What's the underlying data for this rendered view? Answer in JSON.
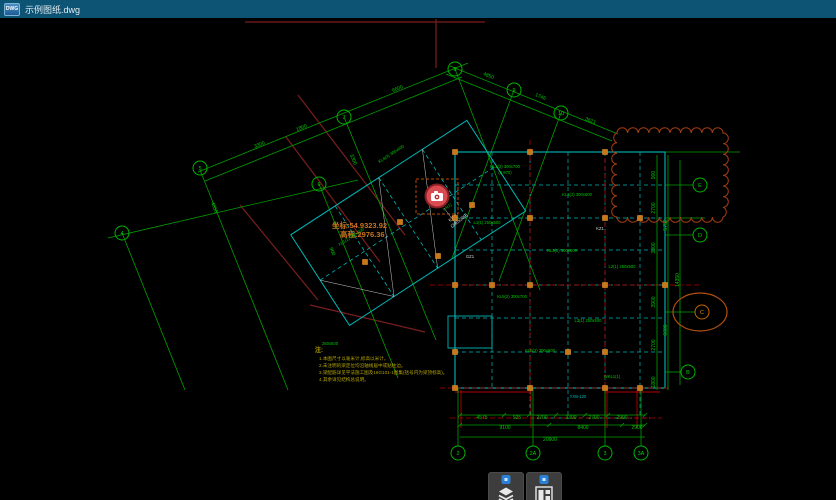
{
  "window": {
    "badge": "DWG",
    "title": "示例图纸.dwg"
  },
  "toolbar": {
    "buttons": [
      {
        "name": "layers-button",
        "icon": "layers-icon"
      },
      {
        "name": "layouts-button",
        "icon": "layouts-icon"
      }
    ]
  },
  "colors": {
    "titlebar": "#0d5373",
    "canvas": "#000000",
    "dim_green": "#00c800",
    "axis_green": "#00a000",
    "beam_cyan": "#00b8b8",
    "column_orange": "#c87818",
    "red": "#b40000",
    "dark_red": "#7a1e1e",
    "cloud_orange": "#a03c14",
    "note_yellow": "#b4a400",
    "coord_orange": "#c87420",
    "marker_red": "#d84c52",
    "badge_blue": "#2b7fd4"
  },
  "drawing": {
    "coordinates": {
      "line1": "坐标:54.9323.92",
      "line2": "高程:2976.36"
    },
    "camera_marker": {
      "label_line1": "KZ-1",
      "label_line2": "(300x300)"
    },
    "notes": {
      "title": "注:",
      "items": [
        "1.本图尺寸以毫米计,标高以米计。",
        "2.未注明的梁定位均沿轴线居中或贴柱边。",
        "3.梁配筋详见平法施工图及16G101-1图集(括号内为梁顶标高)。",
        "4.其余详见结构总说明。"
      ]
    },
    "grid_bubbles": [
      {
        "x": 455,
        "y": 69,
        "label": "8"
      },
      {
        "x": 514,
        "y": 90,
        "label": "9"
      },
      {
        "x": 561,
        "y": 113,
        "label": "10"
      },
      {
        "x": 344,
        "y": 117,
        "label": "7"
      },
      {
        "x": 319,
        "y": 184,
        "label": "6"
      },
      {
        "x": 200,
        "y": 168,
        "label": "5"
      },
      {
        "x": 122,
        "y": 233,
        "label": "4"
      },
      {
        "x": 458,
        "y": 453,
        "label": "2"
      },
      {
        "x": 533,
        "y": 453,
        "label": "2A"
      },
      {
        "x": 605,
        "y": 453,
        "label": "3"
      },
      {
        "x": 641,
        "y": 453,
        "label": "3A"
      },
      {
        "x": 700,
        "y": 185,
        "label": "E"
      },
      {
        "x": 700,
        "y": 235,
        "label": "D"
      },
      {
        "x": 702,
        "y": 312,
        "label": "C",
        "highlight": true
      },
      {
        "x": 688,
        "y": 372,
        "label": "B"
      }
    ],
    "dimensions": [
      {
        "x": 482,
        "y": 419,
        "t": "4575"
      },
      {
        "x": 517,
        "y": 419,
        "t": "925"
      },
      {
        "x": 542,
        "y": 419,
        "t": "2700"
      },
      {
        "x": 571,
        "y": 419,
        "t": "3300"
      },
      {
        "x": 594,
        "y": 419,
        "t": "2700"
      },
      {
        "x": 622,
        "y": 419,
        "t": "2900"
      },
      {
        "x": 505,
        "y": 429,
        "t": "9100"
      },
      {
        "x": 583,
        "y": 429,
        "t": "8400"
      },
      {
        "x": 637,
        "y": 429,
        "t": "2900"
      },
      {
        "x": 550,
        "y": 441,
        "t": "20900"
      },
      {
        "x": 655,
        "y": 175,
        "t": "900",
        "r": -90
      },
      {
        "x": 655,
        "y": 208,
        "t": "2700",
        "r": -90
      },
      {
        "x": 655,
        "y": 248,
        "t": "3300",
        "r": -90
      },
      {
        "x": 655,
        "y": 302,
        "t": "3900",
        "r": -90
      },
      {
        "x": 655,
        "y": 345,
        "t": "2700",
        "r": -90
      },
      {
        "x": 655,
        "y": 382,
        "t": "1800",
        "r": -90
      },
      {
        "x": 667,
        "y": 225,
        "t": "5750",
        "r": -90
      },
      {
        "x": 667,
        "y": 330,
        "t": "6600",
        "r": -90
      },
      {
        "x": 679,
        "y": 280,
        "t": "14350",
        "r": -90
      },
      {
        "x": 488,
        "y": 77,
        "t": "4850",
        "r": 22
      },
      {
        "x": 540,
        "y": 98,
        "t": "1746",
        "r": 22
      },
      {
        "x": 590,
        "y": 122,
        "t": "3621",
        "r": 22
      },
      {
        "x": 260,
        "y": 146,
        "t": "3300",
        "r": -22
      },
      {
        "x": 302,
        "y": 129,
        "t": "1800",
        "r": -22
      },
      {
        "x": 398,
        "y": 90,
        "t": "6600",
        "r": -22
      },
      {
        "x": 213,
        "y": 208,
        "t": "4850",
        "r": 68
      },
      {
        "x": 352,
        "y": 160,
        "t": "3300",
        "r": 68
      },
      {
        "x": 331,
        "y": 252,
        "t": "900",
        "r": 68
      }
    ],
    "beam_labels": [
      {
        "x": 505,
        "y": 168,
        "t": "KL1(2) 300x700"
      },
      {
        "x": 505,
        "y": 174,
        "t": "(5.970)"
      },
      {
        "x": 577,
        "y": 196,
        "t": "KL2(2) 300x600"
      },
      {
        "x": 487,
        "y": 224,
        "t": "L1(1) 250x500"
      },
      {
        "x": 562,
        "y": 252,
        "t": "KL3(2) 300x600"
      },
      {
        "x": 622,
        "y": 268,
        "t": "L2(1) 250x500"
      },
      {
        "x": 512,
        "y": 298,
        "t": "KL5(2) 300x700"
      },
      {
        "x": 588,
        "y": 322,
        "t": "L3(1) 250x500"
      },
      {
        "x": 540,
        "y": 352,
        "t": "KL6(2) 300x600"
      },
      {
        "x": 612,
        "y": 378,
        "t": "WKL1(1)"
      },
      {
        "x": 578,
        "y": 398,
        "t": "YXB-120",
        "c": "#00b8b8"
      },
      {
        "x": 352,
        "y": 238,
        "t": "XL1(1) 250x500",
        "r": -33
      },
      {
        "x": 392,
        "y": 155,
        "t": "KL8(3) 300x600",
        "r": -33
      },
      {
        "x": 448,
        "y": 208,
        "t": "L4(1)",
        "r": -33
      },
      {
        "x": 470,
        "y": 258,
        "t": "GZ1",
        "c": "#d8d8d8"
      },
      {
        "x": 600,
        "y": 230,
        "t": "KZ1",
        "c": "#d8d8d8"
      },
      {
        "x": 330,
        "y": 345,
        "t": "250x500"
      }
    ],
    "columns": [
      [
        455,
        152
      ],
      [
        530,
        152
      ],
      [
        605,
        152
      ],
      [
        455,
        218
      ],
      [
        530,
        218
      ],
      [
        605,
        218
      ],
      [
        640,
        218
      ],
      [
        455,
        285
      ],
      [
        492,
        285
      ],
      [
        530,
        285
      ],
      [
        605,
        285
      ],
      [
        665,
        285
      ],
      [
        455,
        352
      ],
      [
        568,
        352
      ],
      [
        605,
        352
      ],
      [
        455,
        388
      ],
      [
        530,
        388
      ],
      [
        605,
        388
      ],
      [
        640,
        388
      ],
      [
        400,
        222
      ],
      [
        365,
        262
      ],
      [
        438,
        256
      ],
      [
        472,
        205
      ]
    ]
  }
}
